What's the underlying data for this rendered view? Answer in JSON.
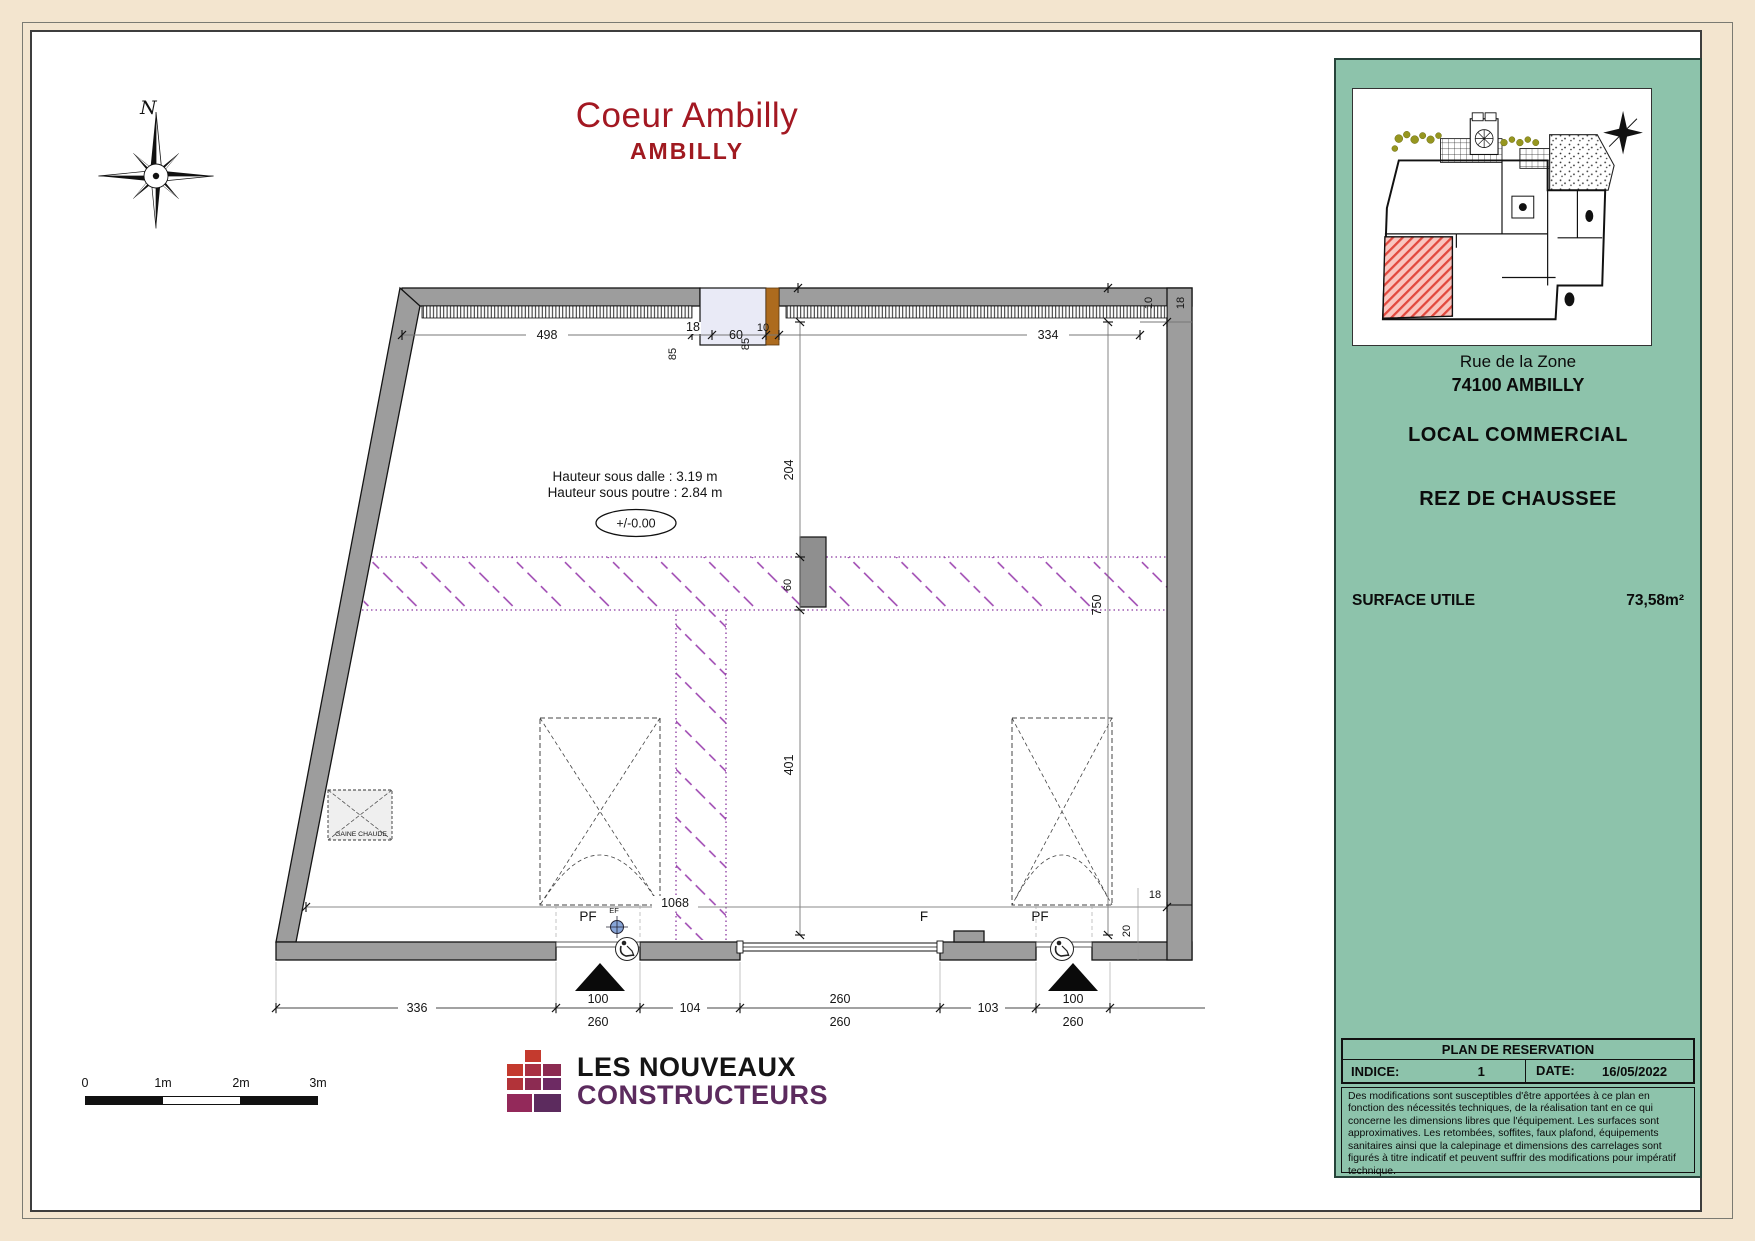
{
  "title": {
    "project": "Coeur Ambilly",
    "city": "AMBILLY"
  },
  "compass": {
    "north": "N"
  },
  "plan": {
    "annotations": {
      "hauteur_dalle": "Hauteur sous dalle : 3.19 m",
      "hauteur_poutre": "Hauteur sous poutre : 2.84 m",
      "niveau": "+/-0.00",
      "gaine_chaude": "GAINE CHAUDE",
      "pf_left": "PF",
      "ef": "EF",
      "f_center": "F",
      "pf_right": "PF"
    },
    "dims": {
      "top_498": "498",
      "top_18": "18",
      "top_60": "60",
      "top_10": "10",
      "top_85_left": "85",
      "top_85_right": "85",
      "top_334": "334",
      "top_10_right": "10",
      "top_18_right": "18",
      "mid_204": "204",
      "mid_60": "60",
      "mid_401": "401",
      "right_750": "750",
      "right_18": "18",
      "right_20": "20",
      "interior_1068": "1068",
      "bottom_336": "336",
      "bottom_100_left": "100",
      "bottom_260_left": "260",
      "bottom_104": "104",
      "bottom_260_top": "260",
      "bottom_260_bot": "260",
      "bottom_103": "103",
      "bottom_100_right": "100",
      "bottom_260_right": "260"
    }
  },
  "sidebar": {
    "address_line1": "Rue de la Zone",
    "address_line2": "74100 AMBILLY",
    "type": "LOCAL COMMERCIAL",
    "level": "REZ DE CHAUSSEE",
    "surface_label": "SURFACE UTILE",
    "surface_value": "73,58m²",
    "reservation": {
      "title": "PLAN DE RESERVATION",
      "indice_label": "INDICE:",
      "indice_value": "1",
      "date_label": "DATE:",
      "date_value": "16/05/2022",
      "disclaimer": "Des modifications sont susceptibles d'être apportées à ce plan en fonction des nécessités techniques, de la réalisation tant en ce qui concerne les dimensions libres que l'équipement. Les surfaces sont approximatives. Les retombées, soffites, faux plafond, équipements sanitaires ainsi que la calepinage et dimensions des carrelages sont figurés à titre indicatif et peuvent suffrir des modifications pour impératif technique."
    }
  },
  "scalebar": {
    "labels": [
      "0",
      "1m",
      "2m",
      "3m"
    ]
  },
  "logo": {
    "line1": "LES NOUVEAUX",
    "line2": "CONSTRUCTEURS"
  },
  "colors": {
    "accent_red": "#a31822",
    "panel_teal": "#8dc3ab",
    "logo_purple": "#5c2b5e",
    "hatch_purple": "#9a3fae"
  }
}
